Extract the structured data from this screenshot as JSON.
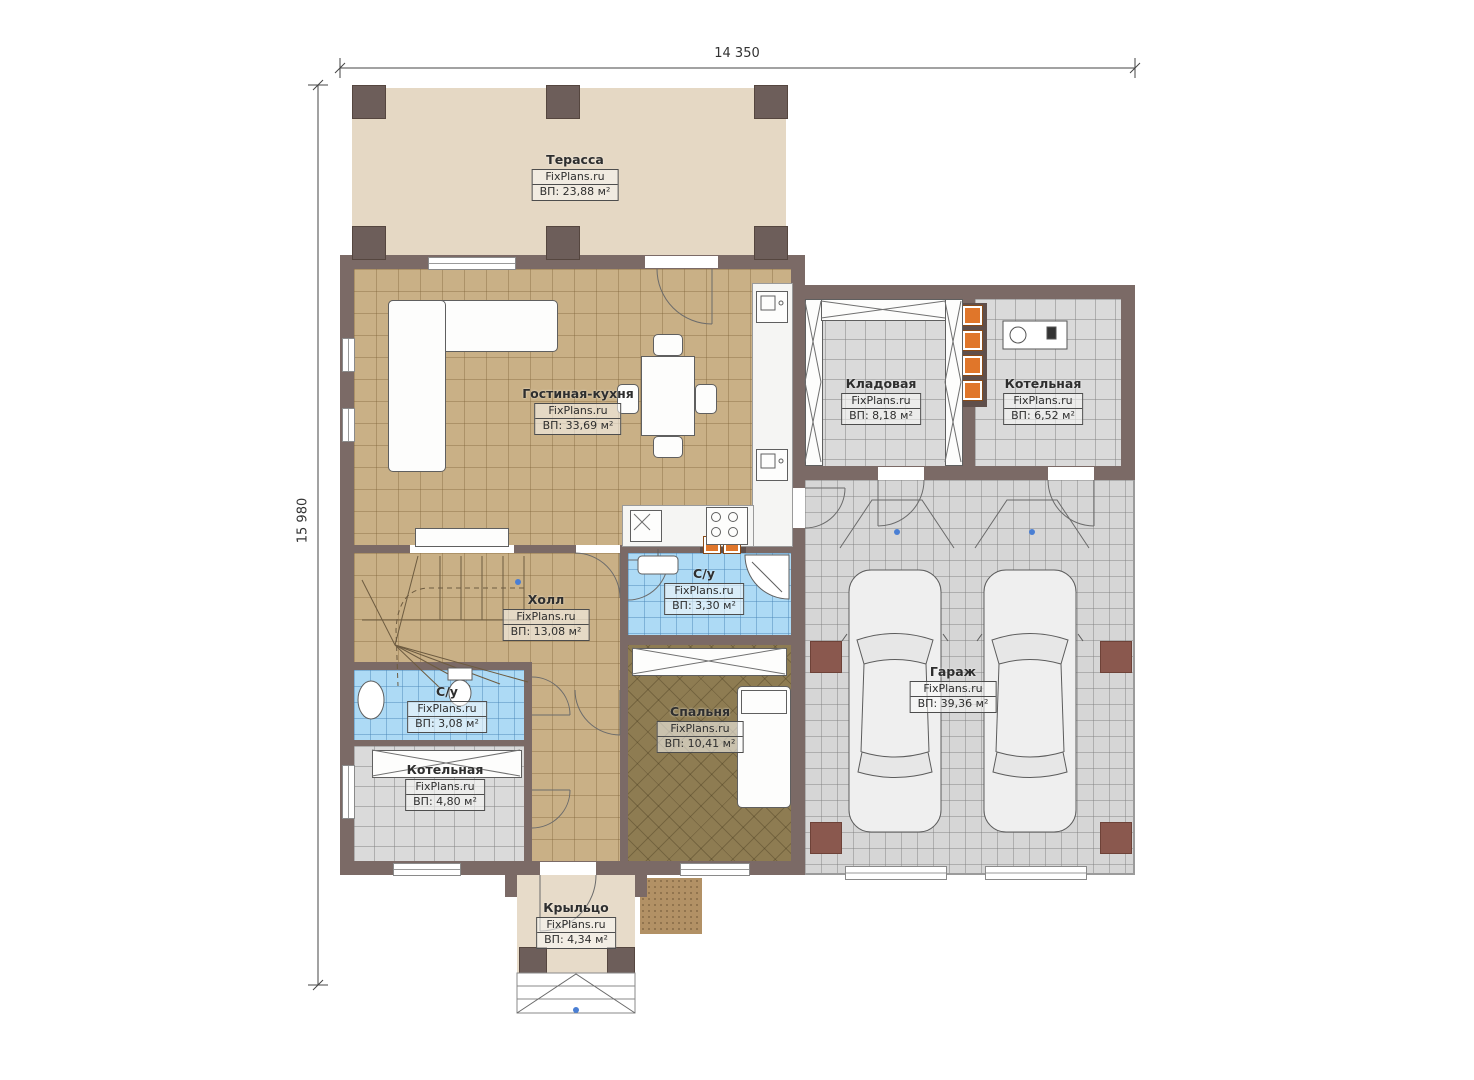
{
  "dimensions": {
    "width_label": "14 350",
    "height_label": "15 980"
  },
  "branding": {
    "watermark": "FixPlans.ru"
  },
  "rooms": {
    "terrace": {
      "name": "Терасса",
      "area": "ВП: 23,88 м²"
    },
    "living": {
      "name": "Гостиная-кухня",
      "area": "ВП: 33,69 м²"
    },
    "storage": {
      "name": "Кладовая",
      "area": "ВП: 8,18 м²"
    },
    "boiler_top": {
      "name": "Котельная",
      "area": "ВП: 6,52 м²"
    },
    "hall": {
      "name": "Холл",
      "area": "ВП: 13,08 м²"
    },
    "bath_top": {
      "name": "С/у",
      "area": "ВП: 3,30 м²"
    },
    "bath_left": {
      "name": "С/у",
      "area": "ВП: 3,08 м²"
    },
    "boiler_left": {
      "name": "Котельная",
      "area": "ВП: 4,80 м²"
    },
    "bedroom": {
      "name": "Спальня",
      "area": "ВП: 10,41 м²"
    },
    "garage": {
      "name": "Гараж",
      "area": "ВП: 39,36 м²"
    },
    "porch": {
      "name": "Крыльцо",
      "area": "ВП: 4,34 м²"
    }
  },
  "colors": {
    "wall": "#7b6a66",
    "terrace_floor": "#e5d8c4",
    "living_floor": "#c9b086",
    "bedroom_floor": "#8e7c52",
    "bath_floor": "#addaf5",
    "tile_gray": "#dadada",
    "garage_floor": "#d6d6d6",
    "garage_pillar": "#8a584e",
    "flue_orange": "#e0762a",
    "marker_blue": "#4a7fd4",
    "porch_floor": "#e7dbc9",
    "label_ink": "#2e2e2e"
  }
}
